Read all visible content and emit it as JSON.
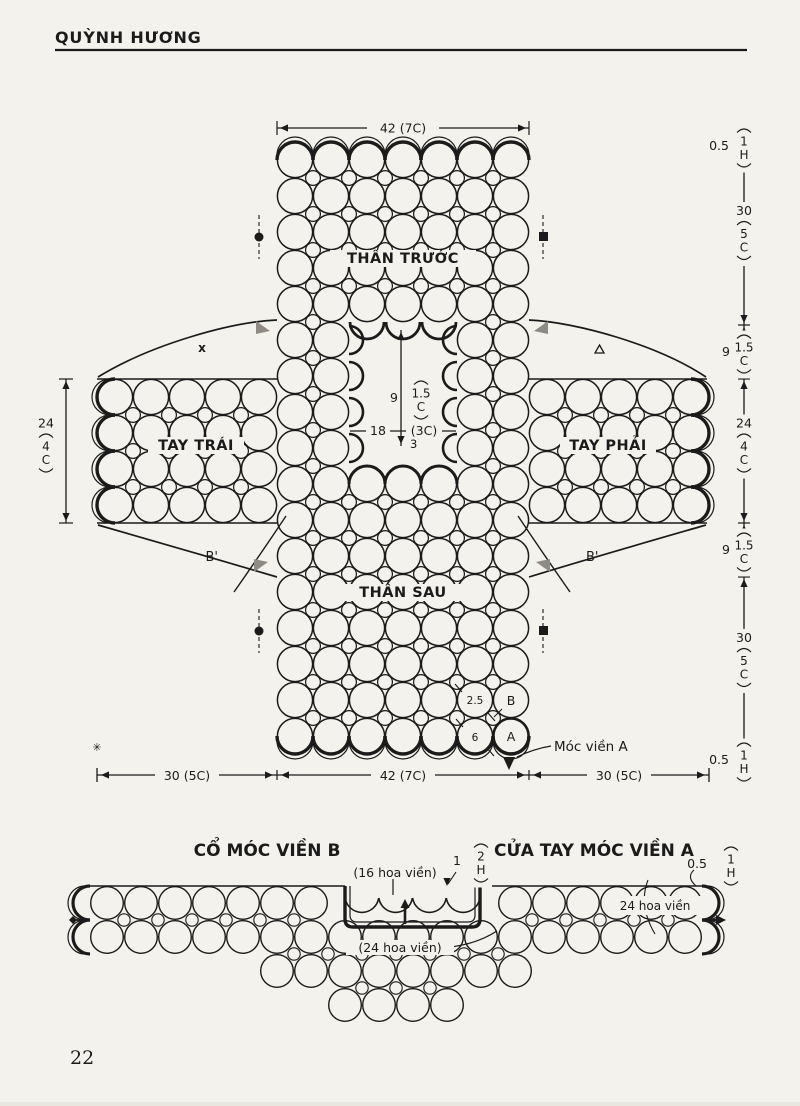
{
  "page": {
    "header": "QUỲNH HƯƠNG",
    "page_number": "22"
  },
  "diagram": {
    "parts": {
      "front": "THÂN TRƯỚC",
      "left_sleeve": "TAY TRÁI",
      "right_sleeve": "TAY PHẢI",
      "back": "THÂN SAU"
    },
    "marks": {
      "b_prime": "B'",
      "x": "x",
      "asterisk": "✳"
    },
    "top_width": "42 (7C)",
    "bottom_widths": [
      "30 (5C)",
      "42 (7C)",
      "30 (5C)"
    ],
    "side_ruler": [
      {
        "num": "0.5",
        "sub": [
          "1",
          "H"
        ],
        "pos": "left"
      },
      {
        "num": "30",
        "sub": [
          "5",
          "C"
        ],
        "pos": "top"
      },
      {
        "num": "9",
        "sub": [
          "1.5",
          "C"
        ],
        "pos": "left"
      },
      {
        "num": "24",
        "sub": [
          "4",
          "C"
        ],
        "pos": "top"
      },
      {
        "num": "9",
        "sub": [
          "1.5",
          "C"
        ],
        "pos": "left"
      },
      {
        "num": "30",
        "sub": [
          "5",
          "C"
        ],
        "pos": "top"
      },
      {
        "num": "0.5",
        "sub": [
          "1",
          "H"
        ],
        "pos": "left"
      }
    ],
    "sleeve_width": {
      "num": "24",
      "sub": [
        "4",
        "C"
      ],
      "pos": "top"
    },
    "neck": {
      "depth": {
        "num": "9",
        "sub": [
          "1.5",
          "C"
        ],
        "pos": "left"
      },
      "width_value": "18",
      "width_unit": "(3C)",
      "back_drop": "3"
    },
    "motifs": {
      "small_diameter": "2.5",
      "small_label": "B",
      "large_diameter": "6",
      "large_label": "A",
      "edge_note": "Móc viền A"
    }
  },
  "bottom_section": {
    "title_left": "CỔ MÓC VIỀN B",
    "title_right": "CỬA TAY MÓC VIỀN A",
    "neck_count": "(16 hoa viền)",
    "neck_count_outer": "(24 hoa viền)",
    "cuff_count": "24 hoa viền",
    "notch_depth": {
      "num": "1",
      "sub": [
        "2",
        "H"
      ],
      "pos": "left"
    },
    "hem": {
      "num": "0.5",
      "sub": [
        "1",
        "H"
      ],
      "pos": "left"
    }
  }
}
